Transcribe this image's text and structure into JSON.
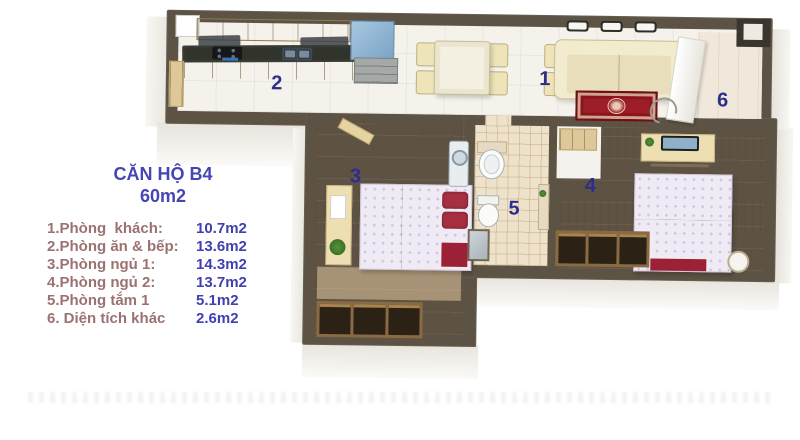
{
  "header": {
    "title": "CĂN HỘ B4",
    "area": "60m2"
  },
  "legend": {
    "items": [
      {
        "label": "1.Phòng  khách:",
        "area": "10.7m2"
      },
      {
        "label": "2.Phòng ăn & bếp:",
        "area": "13.6m2"
      },
      {
        "label": "3.Phòng ngủ 1:",
        "area": "14.3m2"
      },
      {
        "label": "4.Phòng ngủ 2:",
        "area": "13.7m2"
      },
      {
        "label": "5.Phòng tắm 1",
        "area": "5.1m2"
      },
      {
        "label": "6. Diện tích khác",
        "area": "2.6m2"
      }
    ]
  },
  "rooms": [
    {
      "number": "1"
    },
    {
      "number": "2"
    },
    {
      "number": "3"
    },
    {
      "number": "4"
    },
    {
      "number": "5"
    },
    {
      "number": "6"
    }
  ],
  "colors": {
    "title_blue": "#4545b5",
    "label_mauve": "#9c7171",
    "value_blue": "#4040b0",
    "room_number": "#2d2d8c",
    "wall": "#5d5345",
    "wood": "#cc8440",
    "bed_red": "#9c2136",
    "rug_red": "#9e1e28"
  }
}
